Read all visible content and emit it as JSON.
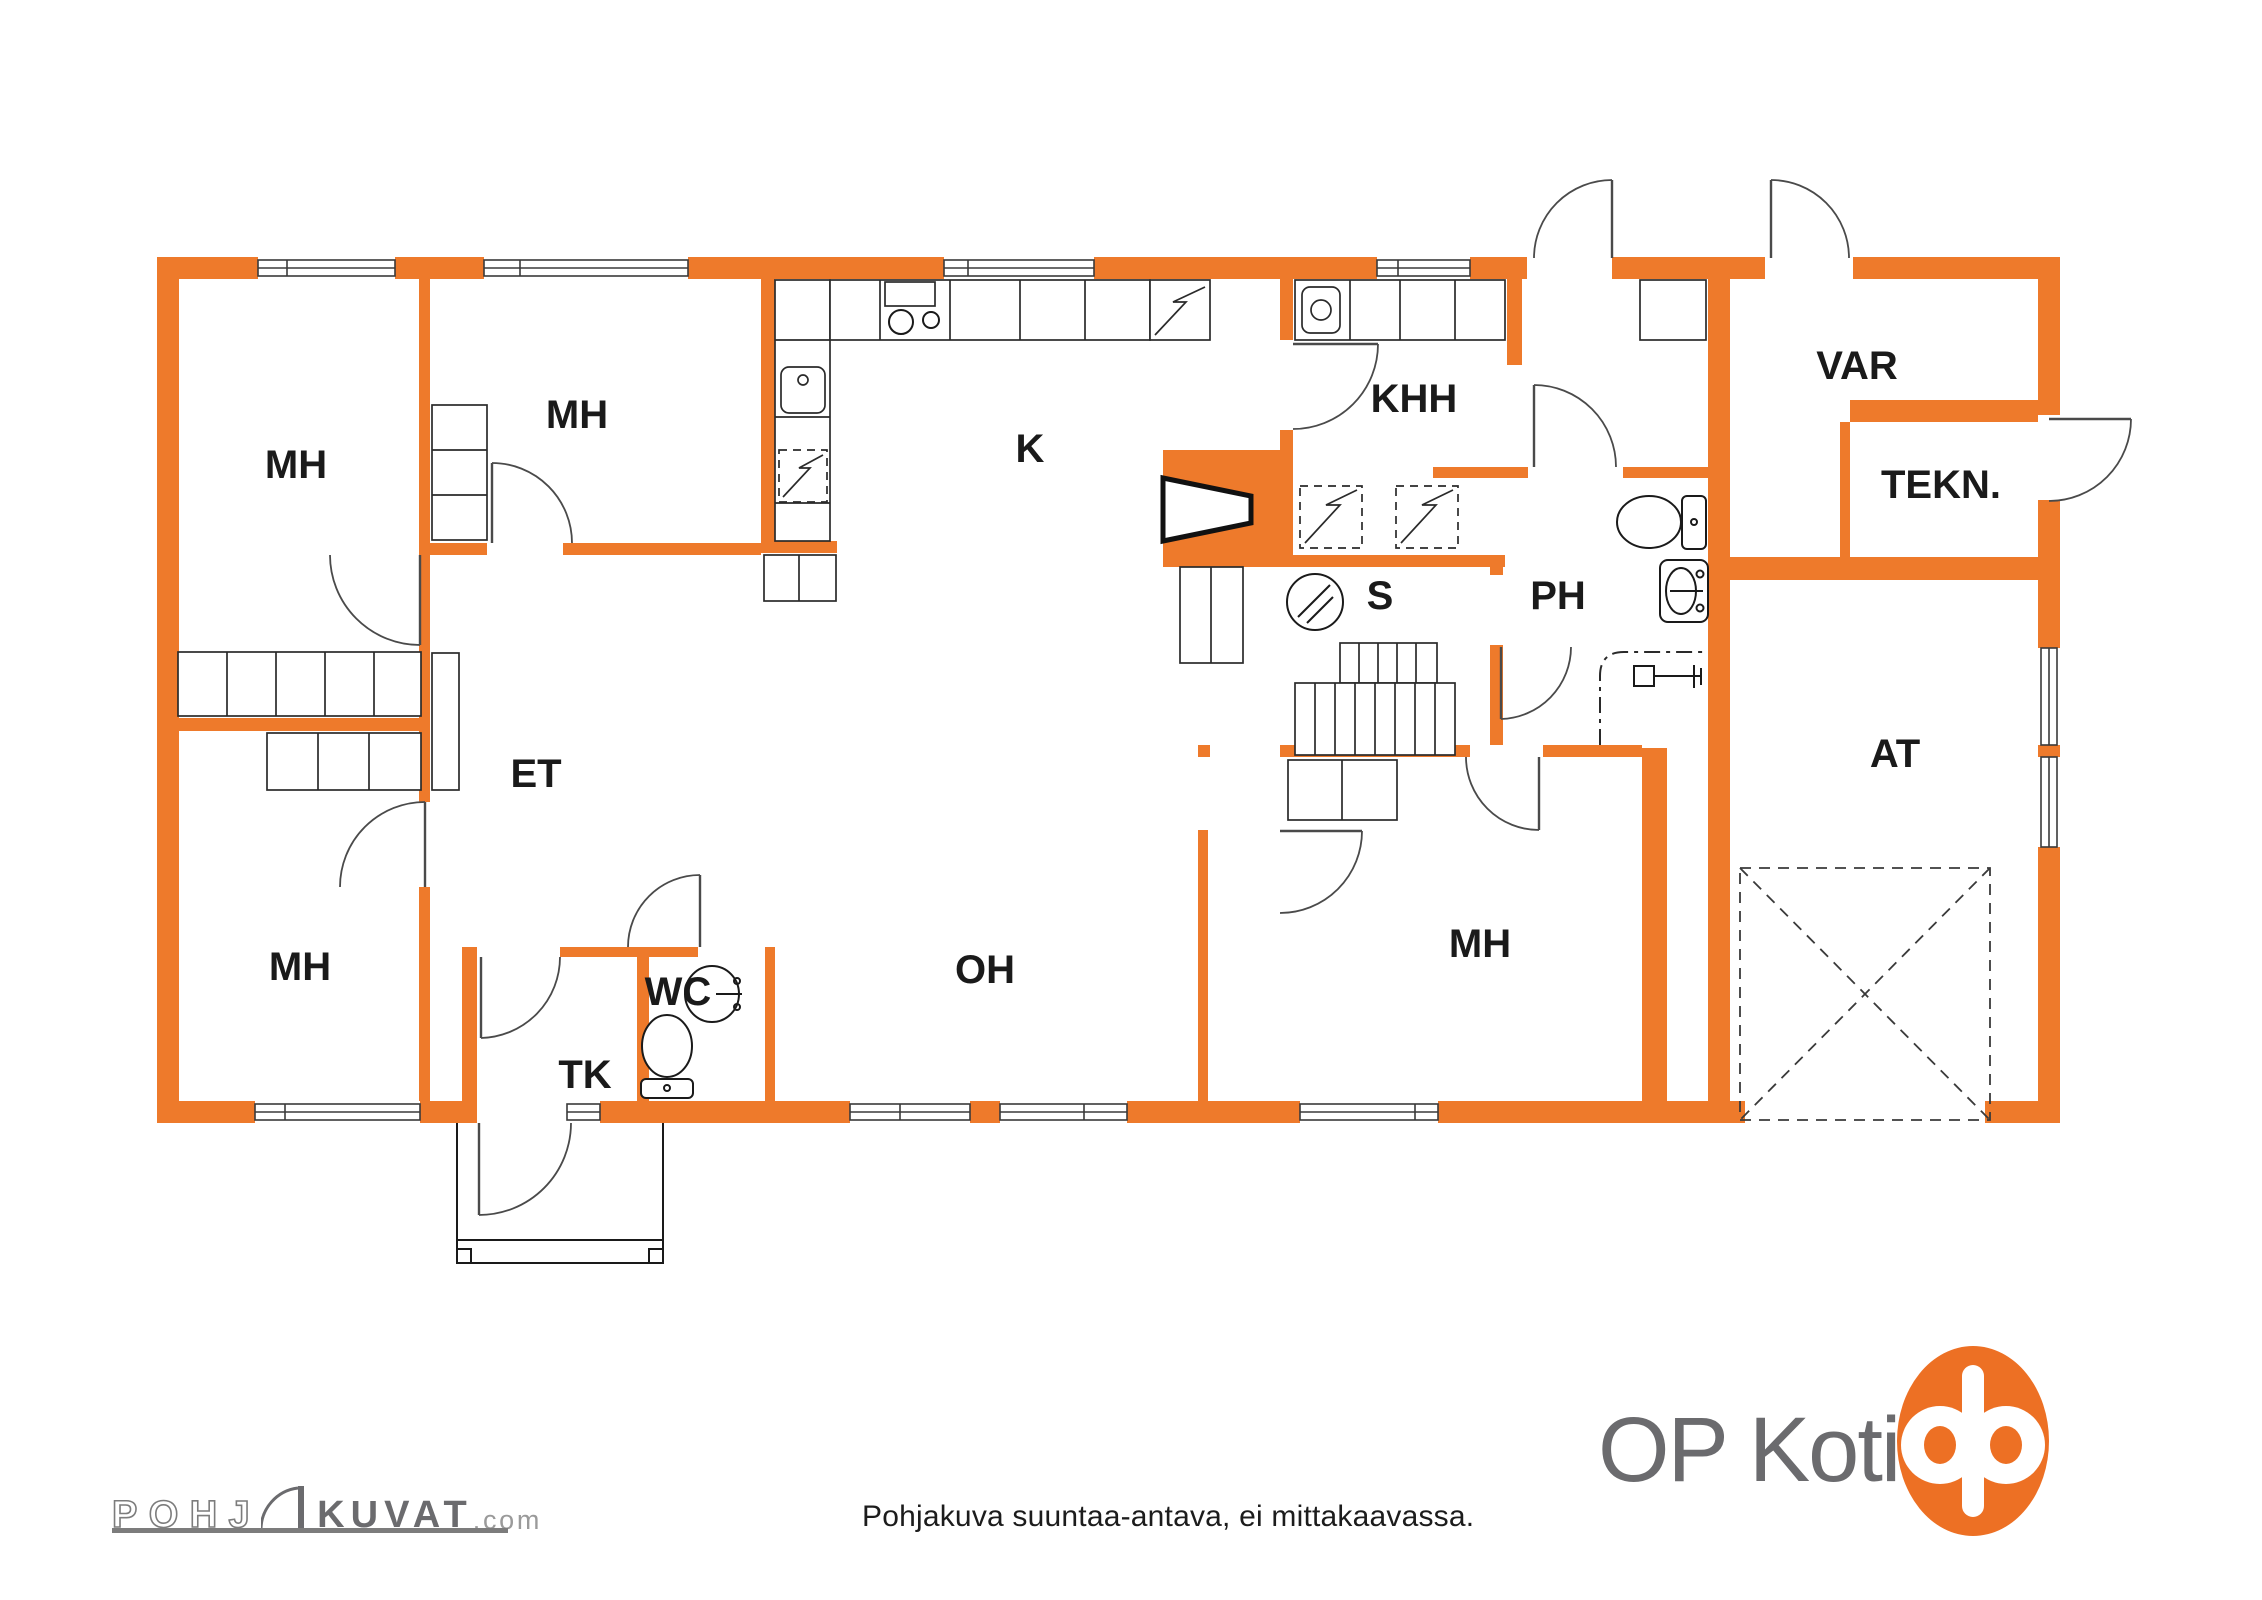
{
  "colors": {
    "wall": "#EE7A2B",
    "ink": "#1a1a1a",
    "door": "#4a4a4a",
    "logoGray": "#6b6b6e",
    "logoLight": "#9a9a9a",
    "op": "#ED7024",
    "caption": "#1c1c1c"
  },
  "plan": {
    "labels": [
      {
        "id": "mh-top-left",
        "text": "MH"
      },
      {
        "id": "mh-top",
        "text": "MH"
      },
      {
        "id": "kitchen",
        "text": "K"
      },
      {
        "id": "utility",
        "text": "KHH"
      },
      {
        "id": "storage",
        "text": "VAR"
      },
      {
        "id": "technical",
        "text": "TEKN."
      },
      {
        "id": "sauna",
        "text": "S"
      },
      {
        "id": "washroom",
        "text": "PH"
      },
      {
        "id": "hall",
        "text": "ET"
      },
      {
        "id": "wc",
        "text": "WC"
      },
      {
        "id": "vestibule",
        "text": "TK"
      },
      {
        "id": "living-room",
        "text": "OH"
      },
      {
        "id": "mh-bottom-left",
        "text": "MH"
      },
      {
        "id": "mh-bottom-right",
        "text": "MH"
      },
      {
        "id": "garage",
        "text": "AT"
      }
    ]
  },
  "footer": {
    "pohjakuvat": {
      "part1": "POHJ",
      "part2": "KUVAT",
      "part3": ".com"
    },
    "disclaimer": "Pohjakuva suuntaa-antava, ei mittakaavassa.",
    "brand": "OP Koti"
  }
}
